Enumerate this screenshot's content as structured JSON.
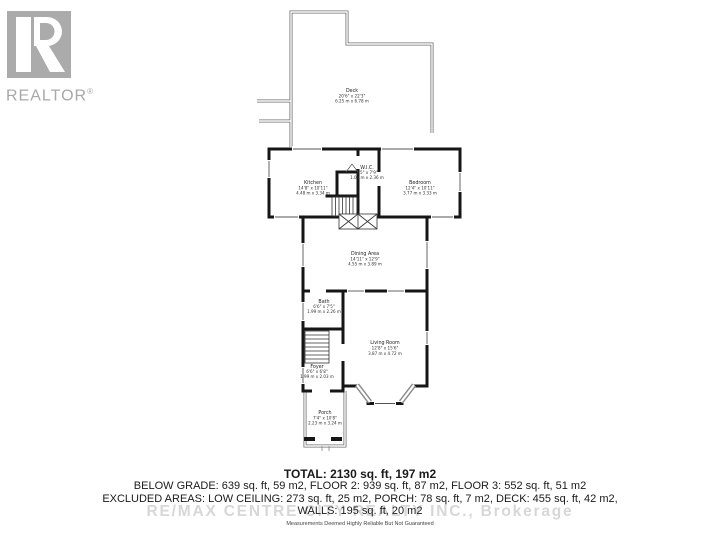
{
  "logo": {
    "brand": "REALTOR",
    "registered_mark": "®"
  },
  "plan": {
    "rooms": {
      "deck": {
        "name": "Deck",
        "dims_ft": "20'6\" x 22'3\"",
        "dims_m": "6.25 m x 6.78 m"
      },
      "kitchen": {
        "name": "Kitchen",
        "dims_ft": "14'8\" x 10'11\"",
        "dims_m": "4.48 m x 3.34 m"
      },
      "wic": {
        "name": "W.I.C.",
        "dims_ft": "3'5\" x 7'9\"",
        "dims_m": "1.04 m x 2.36 m"
      },
      "bedroom": {
        "name": "Bedroom",
        "dims_ft": "12'4\" x 10'11\"",
        "dims_m": "3.77 m x 3.33 m"
      },
      "dining": {
        "name": "Dining Area",
        "dims_ft": "14'11\" x 12'9\"",
        "dims_m": "4.55 m x 3.89 m"
      },
      "bath": {
        "name": "Bath",
        "dims_ft": "6'6\" x 7'5\"",
        "dims_m": "1.99 m x 2.26 m"
      },
      "living": {
        "name": "Living Room",
        "dims_ft": "12'8\" x 15'6\"",
        "dims_m": "3.87 m x 4.72 m"
      },
      "foyer": {
        "name": "Foyer",
        "dims_ft": "6'6\" x 6'8\"",
        "dims_m": "1.99 m x 2.03 m"
      },
      "porch": {
        "name": "Porch",
        "dims_ft": "7'4\" x 10'8\"",
        "dims_m": "2.23 m x 3.24 m"
      }
    }
  },
  "summary": {
    "total": "TOTAL: 2130 sq. ft, 197 m2",
    "floors": "BELOW GRADE: 639 sq. ft, 59 m2, FLOOR 2: 939 sq. ft, 87 m2, FLOOR 3: 552 sq. ft, 51 m2",
    "excluded": "EXCLUDED AREAS: LOW CEILING: 273 sq. ft, 25 m2, PORCH: 78 sq. ft, 7 m2, DECK: 455 sq. ft, 42 m2,",
    "walls": "WALLS: 195 sq. ft, 20 m2",
    "disclaimer": "Measurements Deemed Highly Reliable But Not Guaranteed"
  },
  "watermark": "RE/MAX CENTRE CITY REALTY INC., Brokerage",
  "colors": {
    "wall": "#161616",
    "thin_line": "#6e6e6e",
    "logo_gray": "#ababab",
    "watermark_gray": "#d7d7d7"
  }
}
